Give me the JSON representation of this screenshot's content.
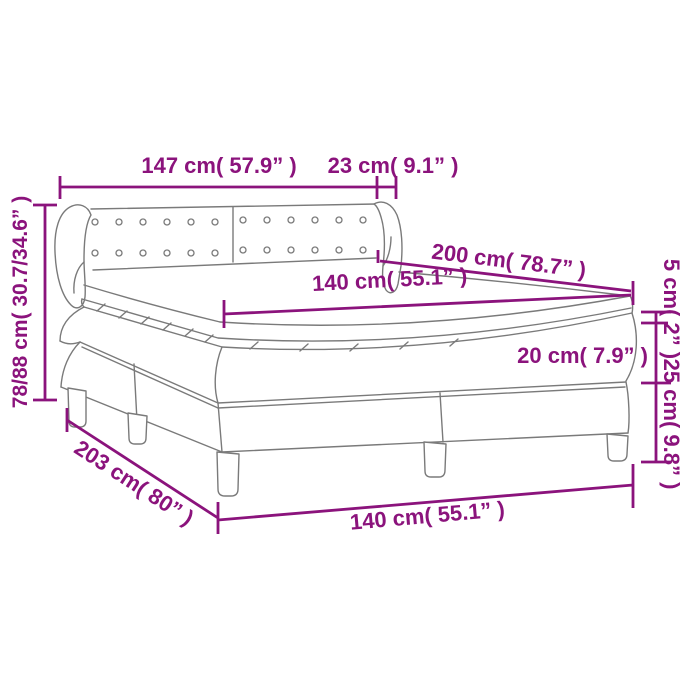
{
  "diagram": {
    "title": "box spring bed with mattress - dimension diagram",
    "colors": {
      "accent": "#8b137c",
      "line": "#7a7a7a",
      "background": "#ffffff"
    },
    "dimensions": {
      "headboard_width": "147 cm( 57.9” )",
      "headboard_side_depth": "23 cm( 9.1” )",
      "height_range": "78/88 cm( 30.7/34.6” )",
      "mattress_length": "200 cm( 78.7” )",
      "mattress_width": "140 cm( 55.1” )",
      "topper_thickness": "5 cm( 2” )",
      "mattress_thickness": "20 cm( 7.9” )",
      "base_height": "25 cm( 9.8” )",
      "frame_length": "203 cm( 80” )",
      "frame_width": "140 cm( 55.1” )"
    }
  }
}
